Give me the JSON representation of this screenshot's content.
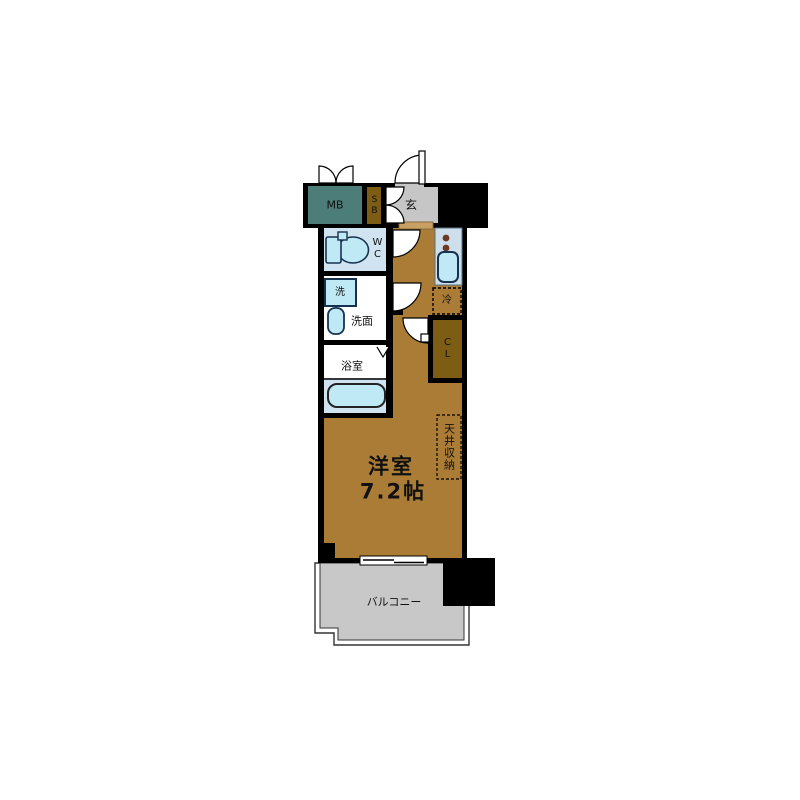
{
  "plan_title": "1K apartment floor plan",
  "labels": {
    "meter_box": "MB",
    "shoe_box": "SB",
    "entrance": "玄",
    "toilet_room": "WC",
    "washing_machine": "洗",
    "washroom": "洗面",
    "bathroom": "浴室",
    "refrigerator": "冷",
    "closet": "CL",
    "ceiling_storage": "天井収納",
    "main_room_name": "洋室",
    "main_room_size": "7.2帖",
    "balcony": "バルコニー"
  },
  "colors": {
    "wall": "#000000",
    "floor": "#ab7c36",
    "closet": "#7d5c13",
    "meter_box": "#4d7d78",
    "entrance": "#c6c6c6",
    "balcony": "#c8c8c8",
    "kitchen": "#ccdfea",
    "wet_room": "#cfe3f0",
    "fixture": "#bfeaf5",
    "fixture_stroke": "#16324f",
    "step": "#c9a063",
    "white": "#ffffff"
  }
}
